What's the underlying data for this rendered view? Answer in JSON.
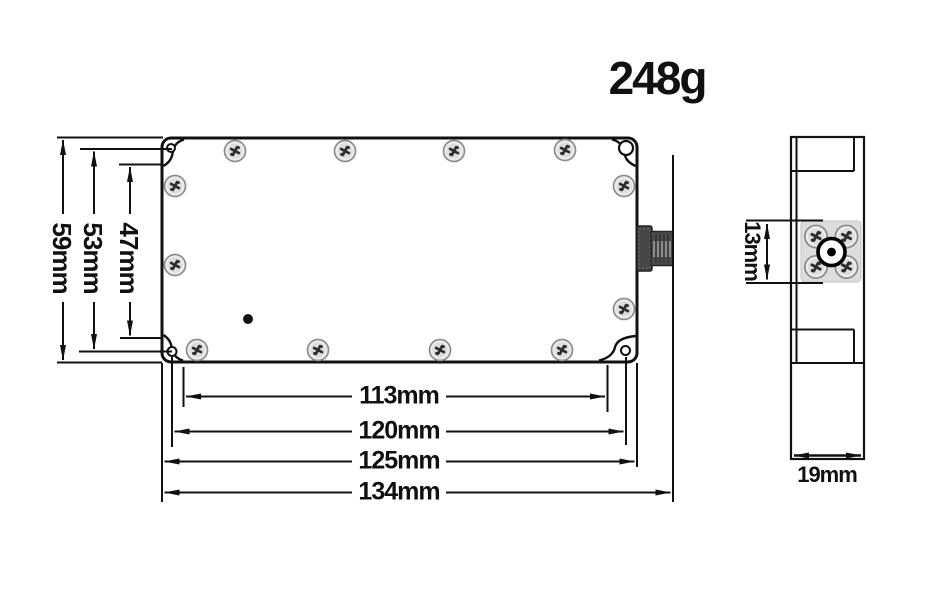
{
  "diagram": {
    "weight_label": "248g",
    "top_view": {
      "vertical_dimensions": [
        {
          "label": "59mm",
          "value_mm": 59
        },
        {
          "label": "53mm",
          "value_mm": 53
        },
        {
          "label": "47mm",
          "value_mm": 47
        }
      ],
      "horizontal_dimensions": [
        {
          "label": "113mm",
          "value_mm": 113
        },
        {
          "label": "120mm",
          "value_mm": 120
        },
        {
          "label": "125mm",
          "value_mm": 125
        },
        {
          "label": "134mm",
          "value_mm": 134
        }
      ],
      "screw_count": 12,
      "corner_hole_count": 4
    },
    "side_view": {
      "connector_plate_dimension": {
        "label": "13mm",
        "value_mm": 13
      },
      "width_dimension": {
        "label": "19mm",
        "value_mm": 19
      },
      "plate_screw_count": 4
    },
    "colors": {
      "line": "#111111",
      "plate_fill": "#dddddd",
      "screw_fill": "#ededed",
      "connector_dark": "#454545"
    }
  }
}
